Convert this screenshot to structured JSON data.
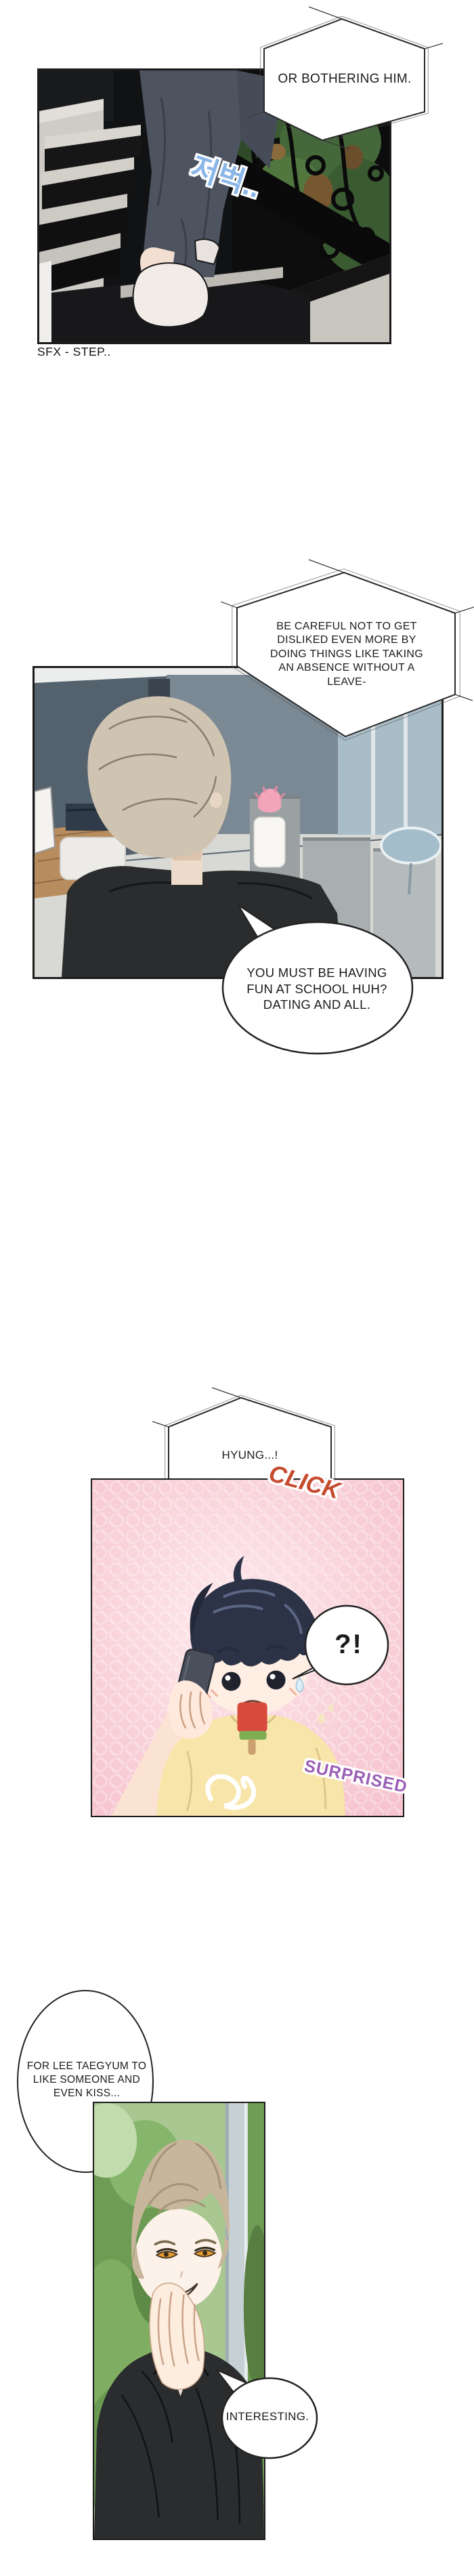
{
  "speech": {
    "or_bothering": "OR BOTHERING HIM.",
    "be_careful": "BE CAREFUL NOT TO GET\nDISLIKED EVEN MORE BY\nDOING THINGS LIKE TAKING\nAN ABSENCE WITHOUT A\nLEAVE-",
    "school_fun": "YOU MUST BE HAVING\nFUN AT SCHOOL HUH?\nDATING AND ALL.",
    "hyung": "HYUNG...!",
    "shock": "?!",
    "for_taegyum": "FOR LEE TAEGYUM TO\nLIKE SOMEONE AND\nEVEN KISS...",
    "interesting": "INTERESTING."
  },
  "sfx": {
    "step_caption": "SFX - STEP..",
    "step_korean": "저벅..",
    "click": "CLICK",
    "surprised": "SURPRISED"
  },
  "colors": {
    "click": "#c64a2e",
    "surprised": "#9a5fb5",
    "step_korean": "#8ab7e8",
    "panel3_background": "#f8cfd8",
    "shirt_yellow": "#f7e5aa",
    "bubble_fill": "#ffffff",
    "line_color": "#1c1c1c"
  }
}
